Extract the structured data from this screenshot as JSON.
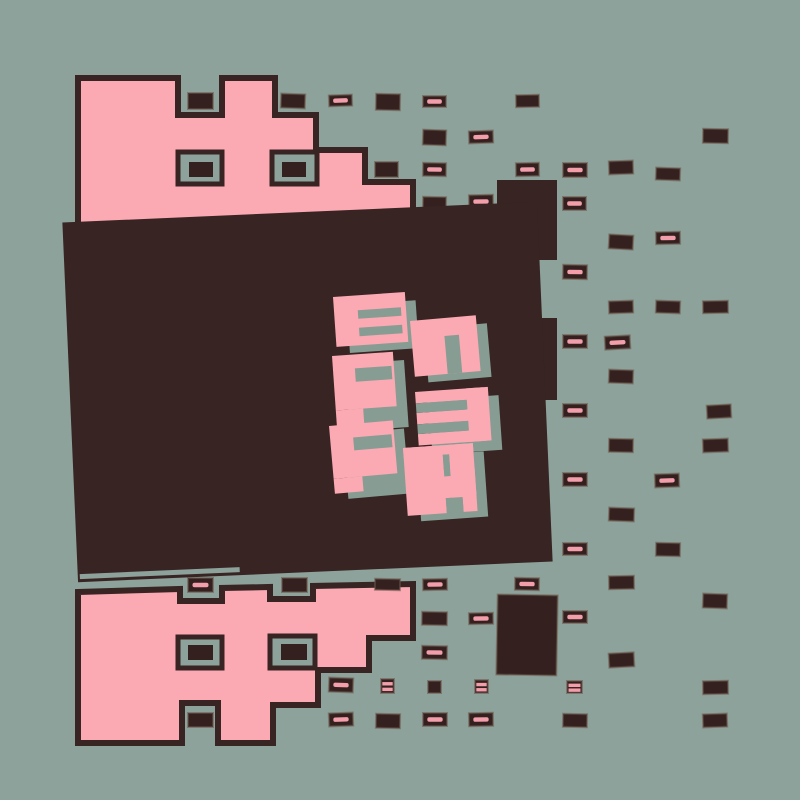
{
  "canvas": {
    "width": 800,
    "height": 800
  },
  "colors": {
    "background": "#8da29b",
    "pink": "#fba9b3",
    "dark": "#372423",
    "rect_fill": "#33201f",
    "rect_stroke": "#6b5648",
    "dash_pink": "#f29fab",
    "shadow_sage": "#879c92",
    "panel": "#372423",
    "outline": "#372423"
  },
  "panel": {
    "x": 70,
    "y": 212,
    "w": 475,
    "h": 360,
    "rotation": -2.5,
    "underline": {
      "x": 72,
      "y": 564,
      "w": 160,
      "h": 5
    },
    "tab": {
      "x": 497,
      "y": 180,
      "w": 60,
      "h": 80
    },
    "right_bar": {
      "x": 531,
      "y": 318,
      "w": 26,
      "h": 82
    }
  },
  "letters": {
    "apparent_text": "B5P3PH",
    "shadow_offset": [
      13,
      9
    ],
    "glyphs": [
      {
        "id": "B",
        "x": 333,
        "y": 297,
        "w": 72,
        "h": 50,
        "rot": -4,
        "pink": [
          [
            0,
            0,
            1,
            1
          ]
        ],
        "holes": [
          [
            0.33,
            0.3,
            0.6,
            0.17
          ],
          [
            0.33,
            0.65,
            0.6,
            0.17
          ]
        ]
      },
      {
        "id": "5",
        "x": 410,
        "y": 321,
        "w": 66,
        "h": 56,
        "rot": -5,
        "pink": [
          [
            0,
            0,
            1,
            1
          ]
        ],
        "holes": [
          [
            0.5,
            0.32,
            0.22,
            0.68
          ]
        ]
      },
      {
        "id": "P1",
        "x": 332,
        "y": 356,
        "w": 61,
        "h": 70,
        "rot": -4,
        "pink": [
          [
            0,
            0,
            1,
            0.78
          ],
          [
            0,
            0.78,
            0.45,
            0.22
          ]
        ],
        "holes": [
          [
            0.36,
            0.2,
            0.6,
            0.19
          ]
        ]
      },
      {
        "id": "3",
        "x": 415,
        "y": 392,
        "w": 73,
        "h": 57,
        "rot": -4,
        "pink": [
          [
            0,
            0,
            0.93,
            0.2
          ],
          [
            0,
            0.37,
            0.93,
            0.2
          ],
          [
            0,
            0.74,
            0.93,
            0.2
          ],
          [
            0.7,
            0,
            0.3,
            0.94
          ]
        ],
        "holes": [
          [
            0,
            0.2,
            0.68,
            0.17
          ],
          [
            0,
            0.57,
            0.68,
            0.17
          ]
        ]
      },
      {
        "id": "P2",
        "x": 329,
        "y": 426,
        "w": 64,
        "h": 68,
        "rot": -5,
        "pink": [
          [
            0,
            0,
            1,
            0.78
          ],
          [
            0,
            0.78,
            0.45,
            0.22
          ]
        ],
        "holes": [
          [
            0.36,
            0.2,
            0.6,
            0.19
          ]
        ]
      },
      {
        "id": "H",
        "x": 403,
        "y": 448,
        "w": 70,
        "h": 68,
        "rot": -4,
        "pink": [
          [
            0,
            0,
            1,
            0.14
          ],
          [
            0,
            0,
            0.56,
            1
          ],
          [
            0.65,
            0,
            0.35,
            0.8
          ],
          [
            0.4,
            0.36,
            0.6,
            0.42
          ],
          [
            0.8,
            0.72,
            0.2,
            0.28
          ]
        ],
        "holes": [
          [
            0.56,
            0.14,
            0.09,
            0.32
          ],
          [
            0.56,
            0.78,
            0.24,
            0.22
          ]
        ]
      }
    ]
  },
  "shapes": {
    "top": {
      "polygon": [
        [
          78,
          78
        ],
        [
          178,
          78
        ],
        [
          178,
          115
        ],
        [
          222,
          115
        ],
        [
          222,
          78
        ],
        [
          275,
          78
        ],
        [
          275,
          115
        ],
        [
          316,
          115
        ],
        [
          316,
          150
        ],
        [
          365,
          150
        ],
        [
          365,
          182
        ],
        [
          413,
          182
        ],
        [
          413,
          235
        ],
        [
          78,
          235
        ]
      ],
      "windows": [
        {
          "x": 178,
          "y": 152,
          "w": 44,
          "h": 32,
          "inner": [
            189,
            162,
            24,
            15
          ]
        },
        {
          "x": 272,
          "y": 152,
          "w": 45,
          "h": 32,
          "inner": [
            282,
            162,
            24,
            15
          ]
        }
      ]
    },
    "bottom": {
      "polygon": [
        [
          78,
          592
        ],
        [
          180,
          589
        ],
        [
          180,
          601
        ],
        [
          222,
          601
        ],
        [
          222,
          588
        ],
        [
          270,
          587
        ],
        [
          270,
          599
        ],
        [
          313,
          599
        ],
        [
          313,
          586
        ],
        [
          413,
          584
        ],
        [
          413,
          638
        ],
        [
          369,
          638
        ],
        [
          369,
          670
        ],
        [
          318,
          670
        ],
        [
          318,
          705
        ],
        [
          273,
          705
        ],
        [
          273,
          743
        ],
        [
          218,
          743
        ],
        [
          218,
          703
        ],
        [
          182,
          703
        ],
        [
          182,
          743
        ],
        [
          78,
          743
        ]
      ],
      "windows": [
        {
          "x": 178,
          "y": 637,
          "w": 44,
          "h": 31,
          "inner": [
            188,
            645,
            25,
            15
          ]
        },
        {
          "x": 270,
          "y": 636,
          "w": 45,
          "h": 32,
          "inner": [
            281,
            644,
            26,
            16
          ]
        }
      ]
    }
  },
  "special_rects": [
    {
      "x": 497,
      "y": 595,
      "w": 60,
      "h": 80,
      "rot": 1
    }
  ],
  "grid_rects": [
    {
      "x": 188,
      "y": 93,
      "w": 25,
      "h": 16,
      "style": "plain",
      "rot": 0
    },
    {
      "x": 281,
      "y": 94,
      "w": 24,
      "h": 14,
      "style": "plain",
      "rot": 2
    },
    {
      "x": 329,
      "y": 95,
      "w": 23,
      "h": 11,
      "style": "dash",
      "rot": -2
    },
    {
      "x": 376,
      "y": 94,
      "w": 24,
      "h": 16,
      "style": "plain",
      "rot": 1
    },
    {
      "x": 423,
      "y": 96,
      "w": 23,
      "h": 11,
      "style": "dash",
      "rot": 0
    },
    {
      "x": 516,
      "y": 95,
      "w": 23,
      "h": 12,
      "style": "plain",
      "rot": -1
    },
    {
      "x": 423,
      "y": 130,
      "w": 23,
      "h": 15,
      "style": "plain",
      "rot": 2
    },
    {
      "x": 469,
      "y": 131,
      "w": 24,
      "h": 12,
      "style": "dash",
      "rot": -2
    },
    {
      "x": 703,
      "y": 129,
      "w": 25,
      "h": 14,
      "style": "plain",
      "rot": 1
    },
    {
      "x": 375,
      "y": 162,
      "w": 23,
      "h": 15,
      "style": "plain",
      "rot": 0
    },
    {
      "x": 423,
      "y": 163,
      "w": 23,
      "h": 13,
      "style": "dash",
      "rot": 1
    },
    {
      "x": 516,
      "y": 163,
      "w": 23,
      "h": 13,
      "style": "dash",
      "rot": -1
    },
    {
      "x": 563,
      "y": 163,
      "w": 24,
      "h": 14,
      "style": "dash",
      "rot": 0
    },
    {
      "x": 609,
      "y": 161,
      "w": 24,
      "h": 13,
      "style": "plain",
      "rot": -2
    },
    {
      "x": 656,
      "y": 168,
      "w": 24,
      "h": 12,
      "style": "plain",
      "rot": 2
    },
    {
      "x": 423,
      "y": 197,
      "w": 23,
      "h": 13,
      "style": "plain",
      "rot": 1
    },
    {
      "x": 469,
      "y": 195,
      "w": 24,
      "h": 13,
      "style": "dash",
      "rot": -1
    },
    {
      "x": 563,
      "y": 197,
      "w": 23,
      "h": 13,
      "style": "dash",
      "rot": 0
    },
    {
      "x": 609,
      "y": 235,
      "w": 24,
      "h": 14,
      "style": "plain",
      "rot": 3
    },
    {
      "x": 656,
      "y": 232,
      "w": 24,
      "h": 12,
      "style": "dash",
      "rot": -1
    },
    {
      "x": 563,
      "y": 265,
      "w": 24,
      "h": 14,
      "style": "dash",
      "rot": 1
    },
    {
      "x": 609,
      "y": 301,
      "w": 24,
      "h": 12,
      "style": "plain",
      "rot": -2
    },
    {
      "x": 656,
      "y": 301,
      "w": 24,
      "h": 12,
      "style": "plain",
      "rot": 2
    },
    {
      "x": 703,
      "y": 301,
      "w": 25,
      "h": 12,
      "style": "plain",
      "rot": -1
    },
    {
      "x": 563,
      "y": 335,
      "w": 24,
      "h": 13,
      "style": "dash",
      "rot": 0
    },
    {
      "x": 605,
      "y": 336,
      "w": 25,
      "h": 13,
      "style": "dash",
      "rot": -3
    },
    {
      "x": 609,
      "y": 370,
      "w": 24,
      "h": 13,
      "style": "plain",
      "rot": 2
    },
    {
      "x": 563,
      "y": 404,
      "w": 24,
      "h": 13,
      "style": "dash",
      "rot": 0
    },
    {
      "x": 707,
      "y": 405,
      "w": 24,
      "h": 13,
      "style": "plain",
      "rot": -3
    },
    {
      "x": 609,
      "y": 439,
      "w": 24,
      "h": 13,
      "style": "plain",
      "rot": 1
    },
    {
      "x": 703,
      "y": 439,
      "w": 25,
      "h": 13,
      "style": "plain",
      "rot": -2
    },
    {
      "x": 563,
      "y": 473,
      "w": 24,
      "h": 13,
      "style": "dash",
      "rot": 0
    },
    {
      "x": 655,
      "y": 474,
      "w": 24,
      "h": 13,
      "style": "dash",
      "rot": -2
    },
    {
      "x": 609,
      "y": 508,
      "w": 25,
      "h": 13,
      "style": "plain",
      "rot": 2
    },
    {
      "x": 563,
      "y": 543,
      "w": 24,
      "h": 12,
      "style": "dash",
      "rot": 0
    },
    {
      "x": 656,
      "y": 543,
      "w": 24,
      "h": 13,
      "style": "plain",
      "rot": 1
    },
    {
      "x": 188,
      "y": 578,
      "w": 25,
      "h": 14,
      "style": "dash",
      "rot": 0
    },
    {
      "x": 282,
      "y": 578,
      "w": 25,
      "h": 14,
      "style": "plain",
      "rot": 0
    },
    {
      "x": 375,
      "y": 579,
      "w": 25,
      "h": 11,
      "style": "plain",
      "rot": 1
    },
    {
      "x": 423,
      "y": 579,
      "w": 24,
      "h": 11,
      "style": "dash",
      "rot": -1
    },
    {
      "x": 515,
      "y": 578,
      "w": 24,
      "h": 12,
      "style": "dash",
      "rot": 1
    },
    {
      "x": 609,
      "y": 576,
      "w": 25,
      "h": 13,
      "style": "plain",
      "rot": -1
    },
    {
      "x": 703,
      "y": 594,
      "w": 24,
      "h": 14,
      "style": "plain",
      "rot": 2
    },
    {
      "x": 422,
      "y": 612,
      "w": 25,
      "h": 13,
      "style": "plain",
      "rot": 1
    },
    {
      "x": 469,
      "y": 613,
      "w": 24,
      "h": 11,
      "style": "dash",
      "rot": -1
    },
    {
      "x": 563,
      "y": 611,
      "w": 24,
      "h": 12,
      "style": "dash",
      "rot": 0
    },
    {
      "x": 422,
      "y": 646,
      "w": 25,
      "h": 13,
      "style": "dash",
      "rot": 1
    },
    {
      "x": 609,
      "y": 653,
      "w": 25,
      "h": 14,
      "style": "plain",
      "rot": -3
    },
    {
      "x": 329,
      "y": 678,
      "w": 24,
      "h": 14,
      "style": "dash",
      "rot": 2
    },
    {
      "x": 381,
      "y": 679,
      "w": 13,
      "h": 14,
      "style": "stripes",
      "rot": 0
    },
    {
      "x": 428,
      "y": 681,
      "w": 13,
      "h": 12,
      "style": "plain",
      "rot": 0
    },
    {
      "x": 475,
      "y": 680,
      "w": 13,
      "h": 13,
      "style": "stripes",
      "rot": 0
    },
    {
      "x": 567,
      "y": 681,
      "w": 15,
      "h": 12,
      "style": "stripes",
      "rot": 0
    },
    {
      "x": 703,
      "y": 681,
      "w": 25,
      "h": 13,
      "style": "plain",
      "rot": -1
    },
    {
      "x": 188,
      "y": 713,
      "w": 25,
      "h": 14,
      "style": "plain",
      "rot": 0
    },
    {
      "x": 329,
      "y": 713,
      "w": 24,
      "h": 13,
      "style": "dash",
      "rot": -2
    },
    {
      "x": 376,
      "y": 714,
      "w": 24,
      "h": 14,
      "style": "plain",
      "rot": 1
    },
    {
      "x": 423,
      "y": 713,
      "w": 24,
      "h": 13,
      "style": "dash",
      "rot": 0
    },
    {
      "x": 469,
      "y": 713,
      "w": 24,
      "h": 13,
      "style": "dash",
      "rot": -1
    },
    {
      "x": 563,
      "y": 714,
      "w": 24,
      "h": 13,
      "style": "plain",
      "rot": 1
    },
    {
      "x": 703,
      "y": 714,
      "w": 24,
      "h": 13,
      "style": "plain",
      "rot": -2
    }
  ]
}
